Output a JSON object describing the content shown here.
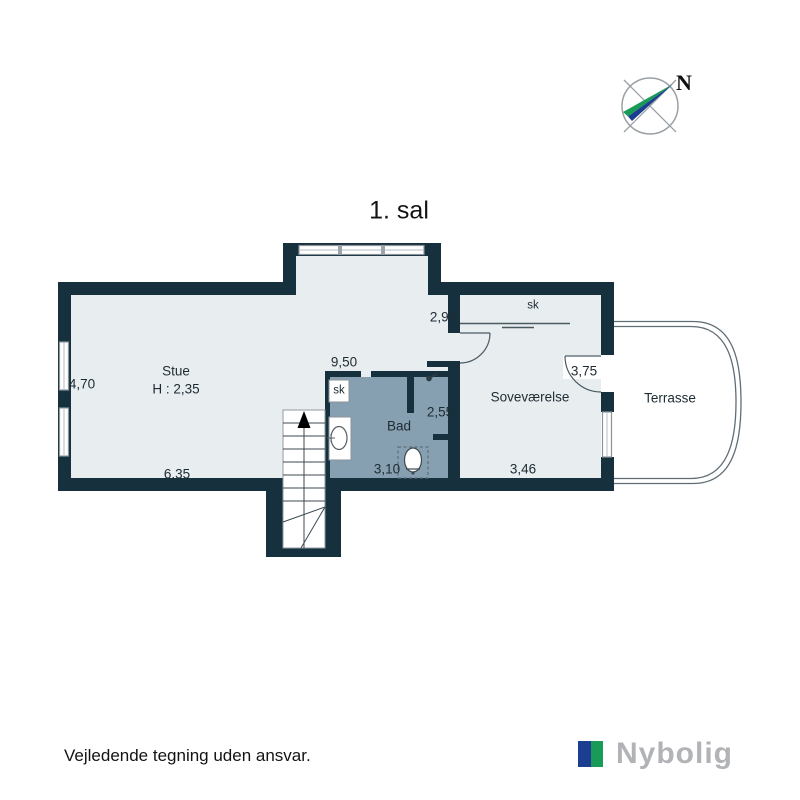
{
  "title": "1. sal",
  "compass": {
    "north_label": "N"
  },
  "plan": {
    "stue": {
      "name": "Stue",
      "ceiling_height": "H : 2,35",
      "bottom_width": "6,35",
      "left_depth": "4,70",
      "top_width": "9,50",
      "right_depth": "2,90"
    },
    "bad": {
      "name": "Bad",
      "bottom_width": "3,10",
      "niche_width": "2,55",
      "closet_label": "sk"
    },
    "sovevaerelse": {
      "name": "Soveværelse",
      "bottom_width": "3,46",
      "terrace_door_width": "3,75",
      "closet_label": "sk"
    },
    "terrasse": {
      "name": "Terrasse"
    }
  },
  "footer": {
    "disclaimer": "Vejledende tegning uden ansvar.",
    "brand": "Nybolig"
  },
  "icons": {
    "compass": "compass-rose-icon",
    "shower": "shower-head-icon",
    "stairs_arrow": "stairs-up-arrow-icon",
    "sink": "sink-icon",
    "toilet": "toilet-icon"
  },
  "colors": {
    "wall": "#16303e",
    "floor": "#e8edf0",
    "bath_floor": "#87a0b1",
    "line": "#4a5a63",
    "brand_blue": "#1c3e90",
    "brand_green": "#179b57",
    "brand_text": "#b1b3b6"
  }
}
